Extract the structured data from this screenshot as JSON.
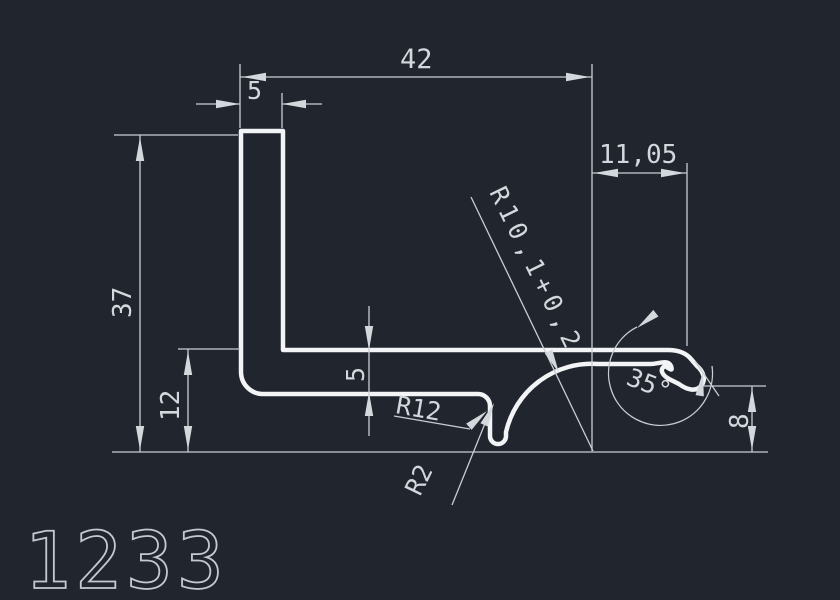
{
  "drawing": {
    "part_number": "1233",
    "dimensions": {
      "total_width": "42",
      "flange_thickness": "5",
      "hook_offset": "11,05",
      "total_height": "37",
      "step_height": "12",
      "web_thickness": "5",
      "hook_height": "8"
    },
    "annotations": {
      "radius_main": "R10,1+0,2",
      "radius_fillet": "R12",
      "radius_groove": "R2",
      "hook_angle": "35°"
    },
    "colors": {
      "background": "#20252e",
      "profile_stroke": "#f2f4f6",
      "dimension_stroke": "#c9cdd3",
      "text_color": "#d4d7dc"
    }
  }
}
